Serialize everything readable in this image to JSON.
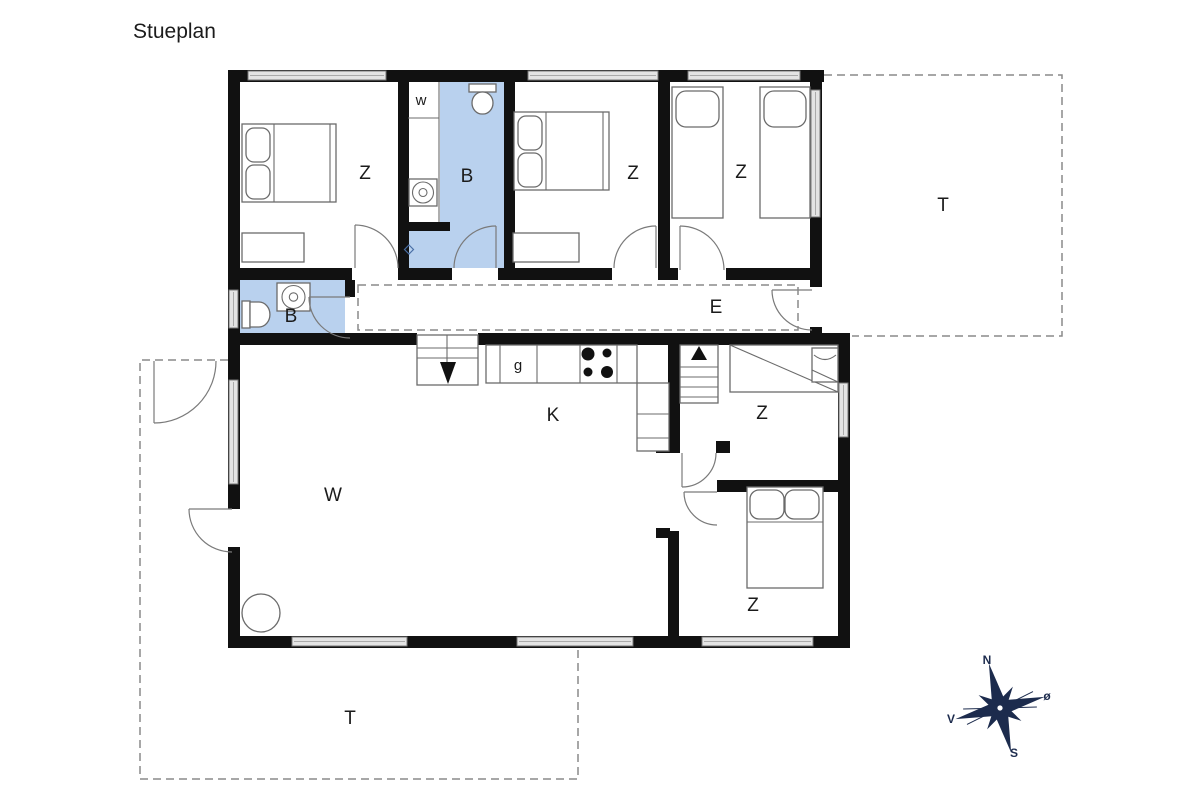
{
  "title": "Stueplan",
  "colors": {
    "wall": "#111111",
    "bathroom_fill": "#b9d1ee",
    "compass": "#1c2b4d",
    "outline_gray": "#6b6b6b",
    "dashed_gray": "#8a8a8a"
  },
  "rooms": {
    "bedroom_nw": "Z",
    "bathroom_top": "B",
    "closet": "w",
    "bedroom_n": "Z",
    "bedroom_ne": "Z",
    "hallway": "E",
    "bathroom_left": "B",
    "pantry": "g",
    "kitchen": "K",
    "living": "W",
    "bedroom_mid": "Z",
    "bedroom_se": "Z",
    "terrace_right": "T",
    "terrace_bottom": "T"
  },
  "compass": {
    "north": "N",
    "east": "ø",
    "south": "S",
    "west": "V"
  }
}
